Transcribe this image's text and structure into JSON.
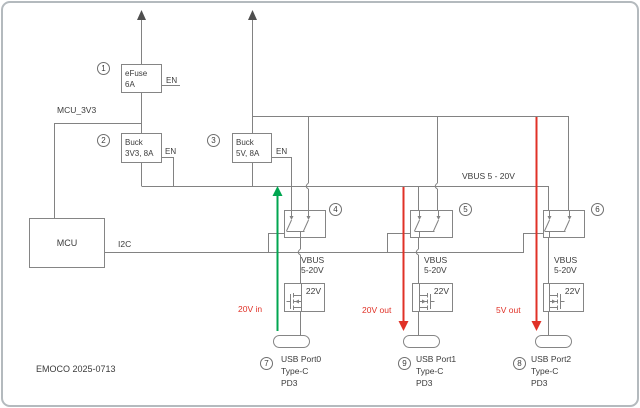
{
  "frame": {
    "footer": "EMOCO 2025-0713"
  },
  "colors": {
    "wire": "#828282",
    "arrowhead": "#4f4f4f",
    "text": "#3b3b3b",
    "flow_in_green": "#00a650",
    "flow_out_red": "#e03127"
  },
  "nets": {
    "mcu_3v3": "MCU_3V3",
    "i2c": "I2C",
    "vbus_bus": "VBUS 5 - 20V"
  },
  "blocks": {
    "efuse": {
      "ref": "1",
      "line1": "eFuse",
      "line2": "6A",
      "en": "EN"
    },
    "buck_3v3": {
      "ref": "2",
      "line1": "Buck",
      "line2": "3V3, 8A",
      "en": "EN"
    },
    "buck_5v": {
      "ref": "3",
      "line1": "Buck",
      "line2": "5V, 8A",
      "en": "EN"
    },
    "mcu": {
      "label": "MCU"
    }
  },
  "switches": [
    {
      "ref": "4"
    },
    {
      "ref": "5"
    },
    {
      "ref": "6"
    }
  ],
  "ports": [
    {
      "ref": "7",
      "vbus_line1": "VBUS",
      "vbus_line2": "5-20V",
      "fet_label": "22V",
      "name": "USB Port0",
      "type": "Type-C",
      "pd": "PD3"
    },
    {
      "ref": "9",
      "vbus_line1": "VBUS",
      "vbus_line2": "5-20V",
      "fet_label": "22V",
      "name": "USB Port1",
      "type": "Type-C",
      "pd": "PD3"
    },
    {
      "ref": "8",
      "vbus_line1": "VBUS",
      "vbus_line2": "5-20V",
      "fet_label": "22V",
      "name": "USB Port2",
      "type": "Type-C",
      "pd": "PD3"
    }
  ],
  "flows": {
    "in": {
      "label": "20V in"
    },
    "out1": {
      "label": "20V out"
    },
    "out2": {
      "label": "5V out"
    }
  }
}
